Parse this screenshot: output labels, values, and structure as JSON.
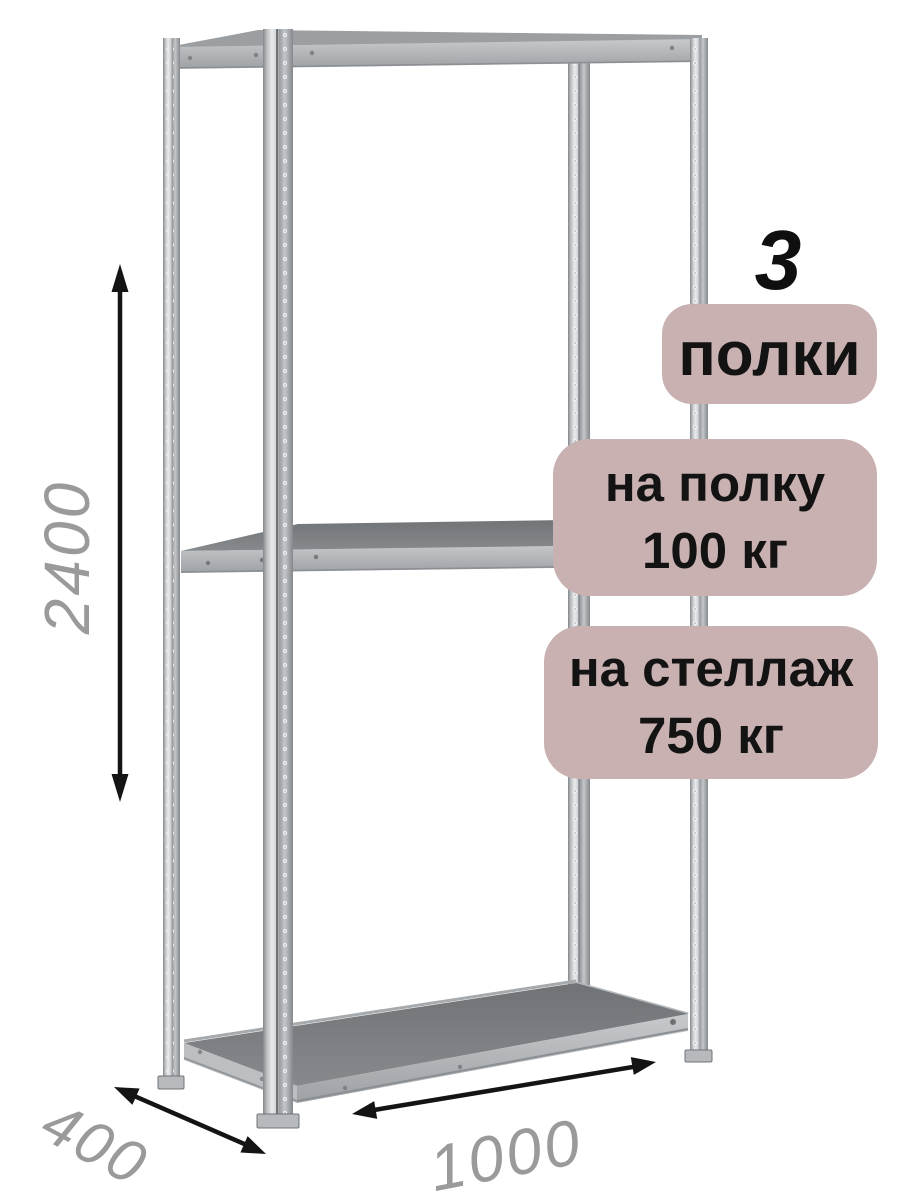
{
  "illustration": {
    "subject": "metal-shelving-rack",
    "shelves_shown": 3,
    "colors": {
      "background": "#ffffff",
      "metal_light": "#e9ebec",
      "metal_mid": "#b2b5b8",
      "metal_dark": "#7c8083",
      "metal_edge": "#6f7377"
    }
  },
  "badges": {
    "bg_color": "#c9b1b1",
    "text_color": "#131313",
    "count_number": "3",
    "count_label": "полки",
    "per_shelf_line1": "на полку",
    "per_shelf_line2": "100 кг",
    "per_rack_line1": "на стеллаж",
    "per_rack_line2": "750 кг"
  },
  "dimensions": {
    "label_color": "#9a9a9a",
    "arrow_color": "#141414",
    "height_mm": "2400",
    "depth_mm": "400",
    "width_mm": "1000"
  }
}
